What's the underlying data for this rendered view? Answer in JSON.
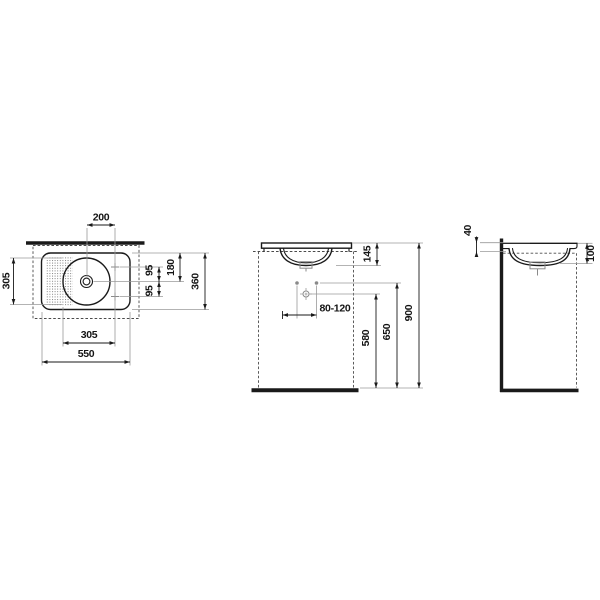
{
  "colors": {
    "line": "#1a1a1a",
    "auxiliary": "#9a9a9a",
    "dashed": "#4a4a4a",
    "text": "#141414",
    "background": "#ffffff"
  },
  "views": {
    "plan": {
      "d200": "200",
      "d305_left": "305",
      "d180": "180",
      "d95_upper": "95",
      "d95_lower": "95",
      "d360": "360",
      "d305_bottom": "305",
      "d550": "550"
    },
    "front": {
      "d145": "145",
      "d80_120": "80-120",
      "d580": "580",
      "d650": "650",
      "d900": "900"
    },
    "side": {
      "d40": "40",
      "d100": "100"
    }
  }
}
